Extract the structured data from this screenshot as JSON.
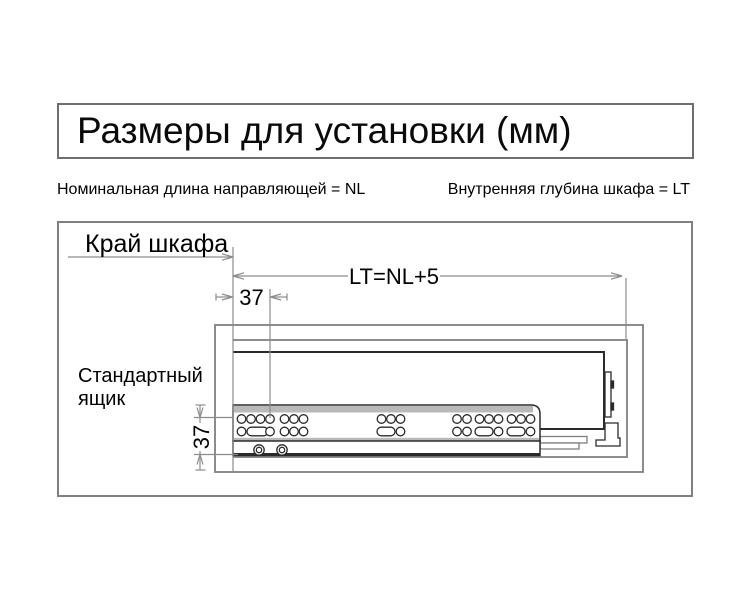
{
  "title": "Размеры для установки (мм)",
  "legend": {
    "nominal_length": "Номинальная длина направляющей = NL",
    "cabinet_depth": "Внутренняя глубина шкафа = LT"
  },
  "diagram": {
    "cabinet_edge_label": "Край шкафа",
    "depth_dimension_label": "LT=NL+5",
    "front_hole_offset_mm": "37",
    "bottom_hole_offset_mm": "37",
    "drawer_label_line1": "Стандартный",
    "drawer_label_line2": "ящик"
  },
  "colors": {
    "background": "#ffffff",
    "text": "#000000",
    "box_border_gray": "#6e6e6e",
    "cabinet_outline_gray": "#7f7f7f",
    "dimension_line_gray": "#8c8c8c",
    "drawer_rail_dark": "#2b2b2b",
    "rail_band_fill": "#b9b9b9"
  }
}
